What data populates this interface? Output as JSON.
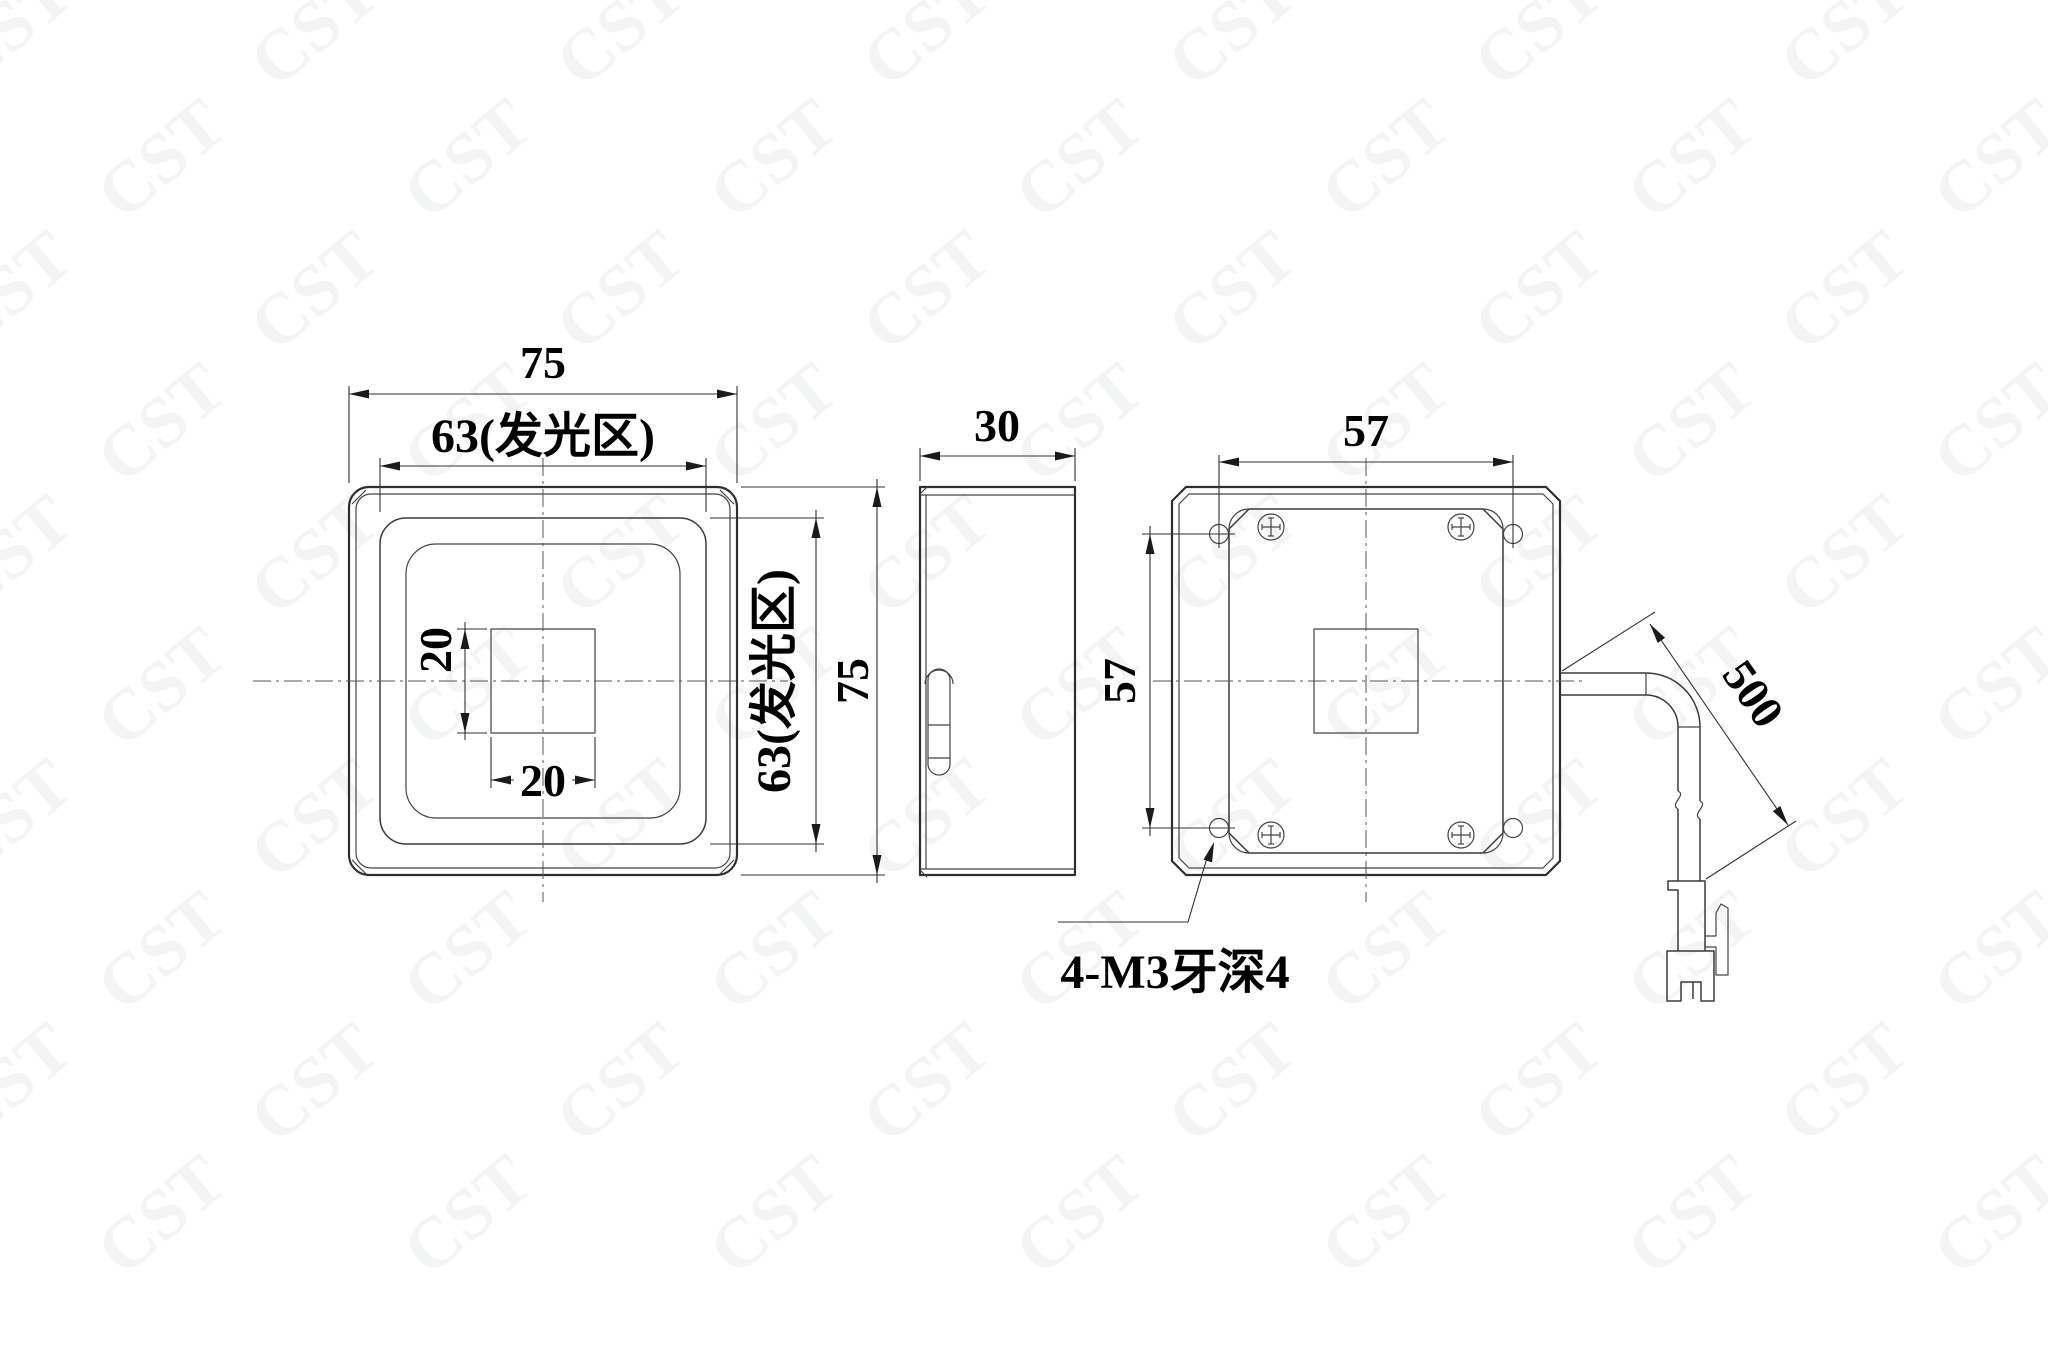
{
  "watermark": {
    "text": "CST"
  },
  "front_view": {
    "dim_overall_width": "75",
    "dim_glow_width": "63(发光区)",
    "dim_center_square_height": "20",
    "dim_center_square_width": "20",
    "dim_glow_height": "63(发光区)",
    "dim_overall_height": "75"
  },
  "side_view": {
    "dim_depth": "30"
  },
  "back_view": {
    "dim_hole_span_horizontal": "57",
    "dim_hole_span_vertical": "57",
    "thread_note": "4-M3牙深4"
  },
  "cable": {
    "dim_length": "500"
  }
}
